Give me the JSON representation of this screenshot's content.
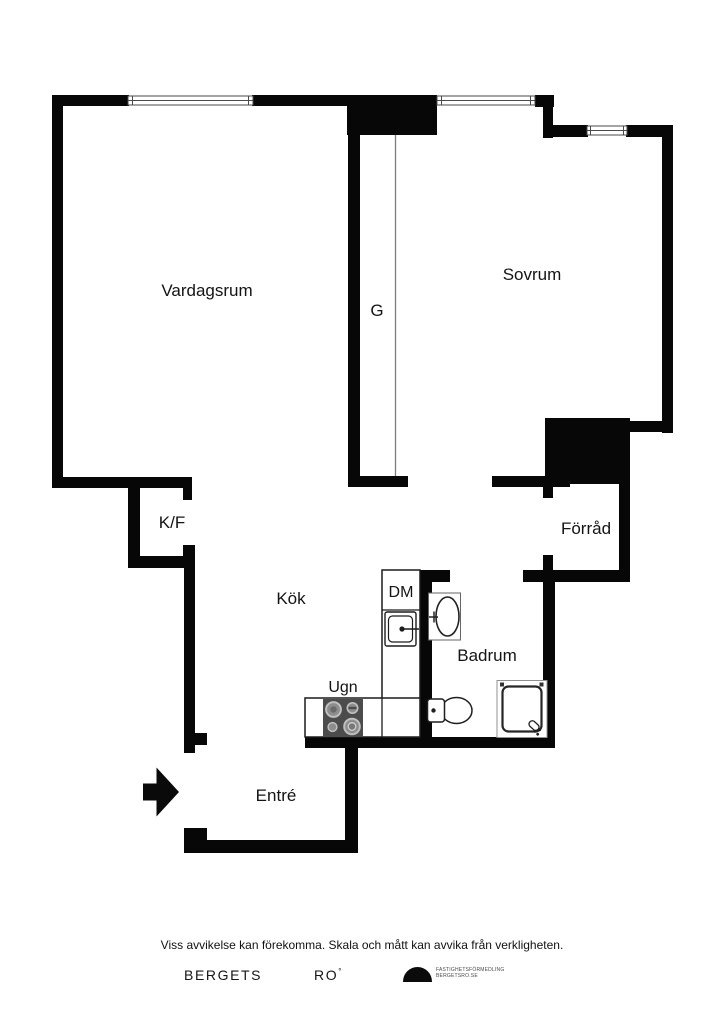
{
  "labels": {
    "vardagsrum": "Vardagsrum",
    "sovrum": "Sovrum",
    "closet": "G",
    "fridge_freezer": "K/F",
    "forrad": "Förråd",
    "kok": "Kök",
    "dishwasher": "DM",
    "badrum": "Badrum",
    "oven": "Ugn",
    "entre": "Entré"
  },
  "footer": {
    "disclaimer": "Viss avvikelse kan förekomma. Skala och mått kan avvika från verkligheten.",
    "brand_primary": "BERGETS",
    "brand_secondary": "RO",
    "brand_mark": "°",
    "logo_line1": "FASTIGHETSFÖRMEDLING",
    "logo_line2": "BERGETSRO.SE"
  },
  "colors": {
    "wall": "#070707",
    "background": "#ffffff",
    "stove_fill": "#4c4c4c",
    "burner_fill": "#8d8d8d",
    "fixture_outline": "#1c1c1c"
  }
}
